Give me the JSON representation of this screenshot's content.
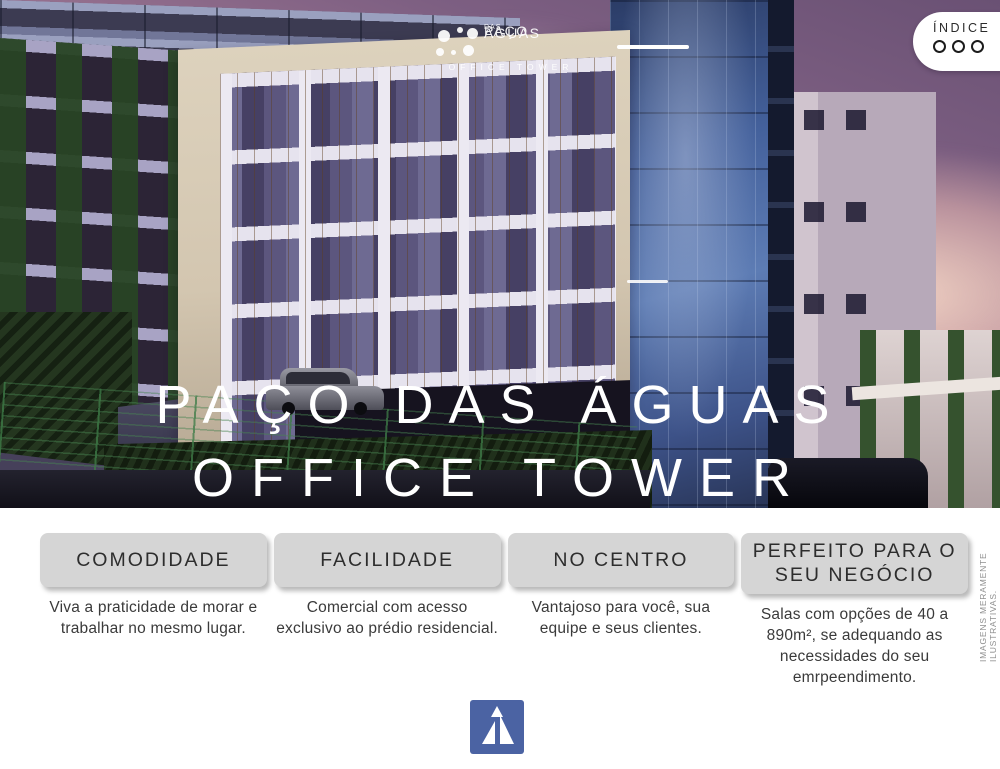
{
  "brand": {
    "name_line1": "PAÇO",
    "name_das": "DAS",
    "name_line2": "ÁGUAS",
    "subtitle": "OFFICE TOWER"
  },
  "indice": {
    "label": "ÍNDICE",
    "dot_count": 3
  },
  "hero": {
    "title_line1": "PAÇO DAS ÁGUAS",
    "title_line2": "OFFICE TOWER"
  },
  "features": [
    {
      "title": "COMODIDADE",
      "description": "Viva a praticidade de morar e trabalhar no mesmo lugar."
    },
    {
      "title": "FACILIDADE",
      "description": "Comercial com acesso exclusivo ao prédio residencial."
    },
    {
      "title": "NO CENTRO",
      "description": "Vantajoso para você, sua equipe e seus clientes."
    },
    {
      "title": "PERFEITO PARA O SEU NEGÓCIO",
      "description": "Salas com opções de 40 a 890m², se adequando as necessidades do seu emrpeendimento."
    }
  ],
  "disclaimer": "IMAGENS MERAMENTE ILUSTRATIVAS.",
  "colors": {
    "footer_logo_blue": "#4b63a3",
    "feature_box_gray": "#d5d5d5",
    "sky_purple": "#7d5f82",
    "sky_pink": "#efc0a4",
    "glass_blue": "#44619c"
  }
}
